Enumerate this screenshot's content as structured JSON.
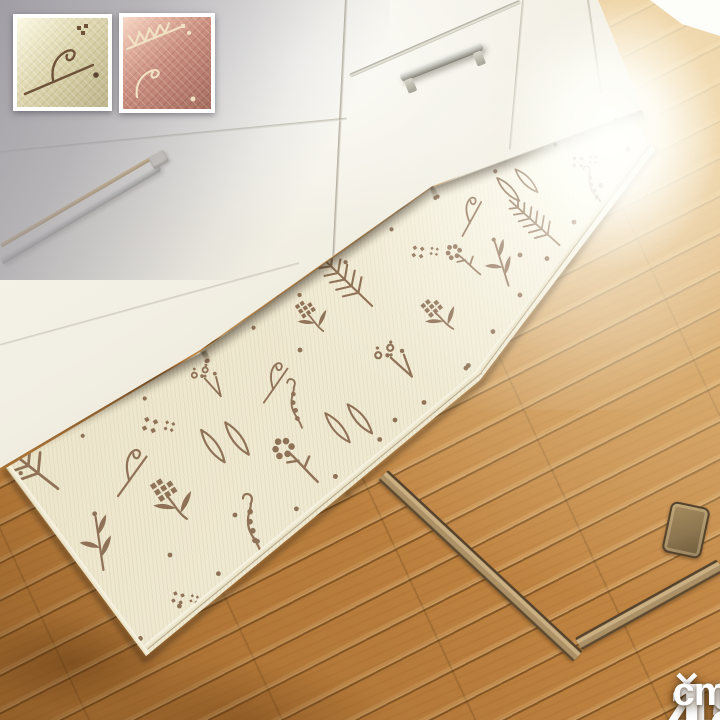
{
  "photo": {
    "subject": "kitchen floor mat in front of white kitchen cabinets on a wooden floor"
  },
  "swatches": {
    "items": [
      {
        "id": "ivory",
        "label": "ivory floral mat swatch",
        "color": "#d8d0a6",
        "motif_color": "#6e5339"
      },
      {
        "id": "pink",
        "label": "pink floral mat swatch",
        "color": "#c4887a",
        "motif_color": "#f0e2c2"
      }
    ]
  },
  "dimension_label": {
    "width": "45",
    "separator": "×",
    "length": "180",
    "unit": "cm",
    "text_color": "#ffffff"
  },
  "scene": {
    "mat_color": "#efe9d1",
    "mat_pattern_color": "#87684e",
    "cabinet_color": "#f3f0e6",
    "floor_color": "#c08442",
    "rail_color": "#ab9165",
    "pattern_motifs": [
      "fern",
      "oval-leaf",
      "pixel-flower",
      "cross-flower",
      "berry-sprig",
      "leaf-branch",
      "curl-sprig",
      "flower-stem",
      "seed-head",
      "dot-border"
    ]
  }
}
